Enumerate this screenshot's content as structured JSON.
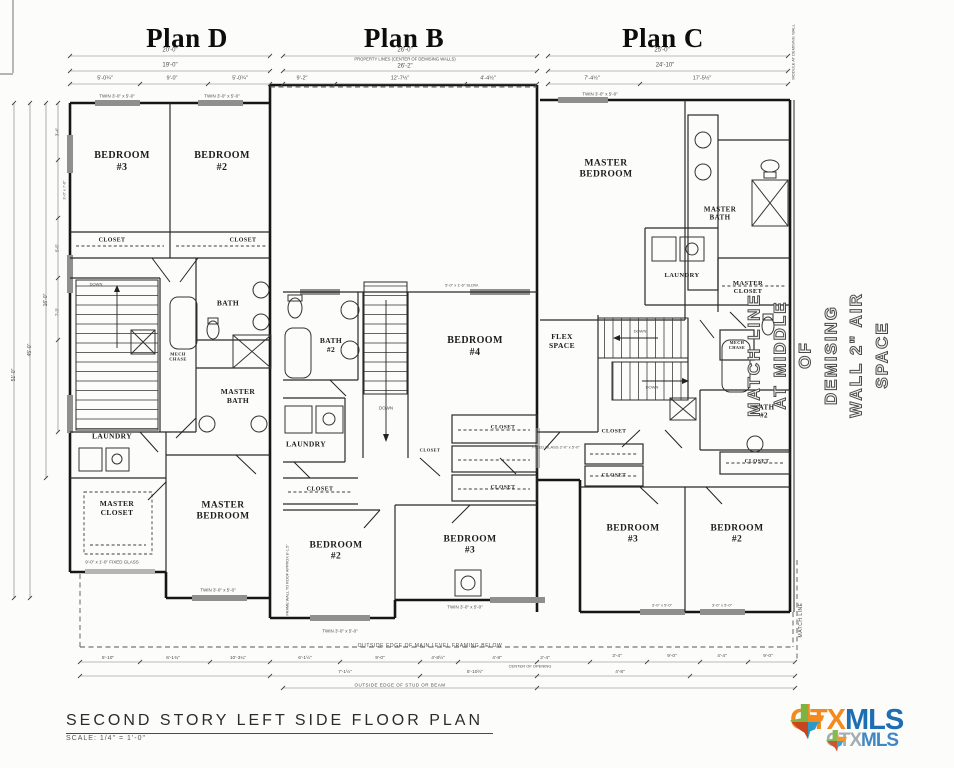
{
  "titles": {
    "d": "Plan D",
    "b": "Plan B",
    "c": "Plan C"
  },
  "plan_d": {
    "bedroom3": "BEDROOM\n#3",
    "bedroom2": "BEDROOM\n#2",
    "closet1": "CLOSET",
    "closet2": "CLOSET",
    "bath": "BATH",
    "mech_chase": "MECH\nCHASE",
    "master_bath": "MASTER\nBATH",
    "laundry": "LAUNDRY",
    "master_closet": "MASTER\nCLOSET",
    "master_bedroom": "MASTER\nBEDROOM",
    "down": "DOWN",
    "fixed_glass": "9'-0\" x 1'-0\"\nFIXED GLASS",
    "window_top_left": "TWIN 3'-0\" x 5'-0\"",
    "window_top_right": "TWIN 3'-0\" x 5'-0\"",
    "window_bottom": "TWIN 3'-0\" x 5'-0\"",
    "dim_row1": "20'-0\"",
    "dim_row2": "19'-0\"",
    "dim_row3a": "5'-0¼\"",
    "dim_row3b": "9'-0\"",
    "dim_row3c": "5'-0¼\""
  },
  "plan_b": {
    "bath2": "BATH\n#2",
    "bedroom4": "BEDROOM\n#4",
    "down": "DOWN",
    "laundry": "LAUNDRY",
    "closet_left": "CLOSET",
    "closet_r1": "CLOSET",
    "closet_r2": "CLOSET",
    "closet_r3": "CLOSET",
    "bedroom2": "BEDROOM\n#2",
    "bedroom3": "BEDROOM\n#3",
    "slider": "5'-0\" x 1'-6\" SLDW.",
    "window_b2": "TWIN 3'-0\" x 5'-0\"",
    "window_b3": "TWIN 3'-0\" x 5'-0\"",
    "frame_wall": "FRAME WALL TO ROOF\nAPPROX 8'-1.5\"",
    "outside_main": "OUTSIDE EDGE OF MAIN LEVEL FRAMING BELOW",
    "dim_row1": "26'-0\"",
    "dim_row2": "26'-2\"",
    "dim_row3a": "9'-2\"",
    "dim_row3b": "12'-7½\"",
    "dim_row3c": "4'-4½\""
  },
  "plan_c": {
    "master_bedroom": "MASTER\nBEDROOM",
    "master_bath": "MASTER\nBATH",
    "laundry": "LAUNDRY",
    "master_closet": "MASTER\nCLOSET",
    "flex": "FLEX\nSPACE",
    "mech_chase": "MECH\nCHASE",
    "bath2": "BATH\n#2",
    "closet1": "CLOSET",
    "closet2": "CLOSET",
    "closet3": "CLOSET",
    "bedroom3": "BEDROOM\n#3",
    "bedroom2": "BEDROOM\n#2",
    "down1": "DOWN",
    "down2": "DOWN",
    "fixed_glass": "FIXED GLASS\n2'-0\" x 5'-0\"",
    "window_top": "TWIN 3'-0\" x 5'-0\"",
    "window_b3": "3'-0\" x 5'-0\"",
    "window_b2": "3'-0\" x 5'-0\"",
    "dim_row1": "25'-0\"",
    "dim_row2": "24'-10\"",
    "dim_row3a": "7'-4½\"",
    "dim_row3b": "17'-5½\""
  },
  "annotations": {
    "property_line": "PROPERTY LINES (CENTER OF DEMISING WALLS)",
    "match_line_big": "MATCH LINE AT MIDDLE OF\nDEMISING WALL 2\" AIR SPACE",
    "module": "MODULE AT\nDEMISING WALL",
    "match_line_small": "MATCH LINE",
    "center_opening": "CENTER OF OPENING",
    "outside_stud": "OUTSIDE EDGE OF STUD OR BEAM"
  },
  "dims": {
    "left": [
      "51'-0\"",
      "45'-0\"",
      "16'-0\"",
      "3'-4\"",
      "5'-5\"",
      "7'-3\"",
      "3'-0\" x 7'-6\""
    ],
    "bottom_d": [
      "5'-10\"",
      "6'-1¾\"",
      "10'-3¼\""
    ],
    "bottom_row1": [
      "6'-1½\"",
      "9'-0\"",
      "4'-8½\"",
      "4'-8\"",
      "2'-4\""
    ],
    "bottom_row2": [
      "7'-1½\"",
      "5'-10½\"",
      "4'-8\""
    ],
    "bottom_c": [
      "3'-4\"",
      "9'-0\"",
      "4'-4\"",
      "9'-0\""
    ]
  },
  "footer": {
    "title": "SECOND STORY LEFT SIDE FLOOR PLAN",
    "scale": "SCALE: 1/4\" = 1'-0\""
  },
  "logo": {
    "ctx": "CTX",
    "mls": "MLS",
    "ctx_color": "#F28A1E",
    "mls_color": "#1C6EB5",
    "tx_green": "#7CB342",
    "tx_orange": "#F28A1E",
    "tx_red": "#C8431F",
    "tx_blue": "#2C9AC4"
  }
}
